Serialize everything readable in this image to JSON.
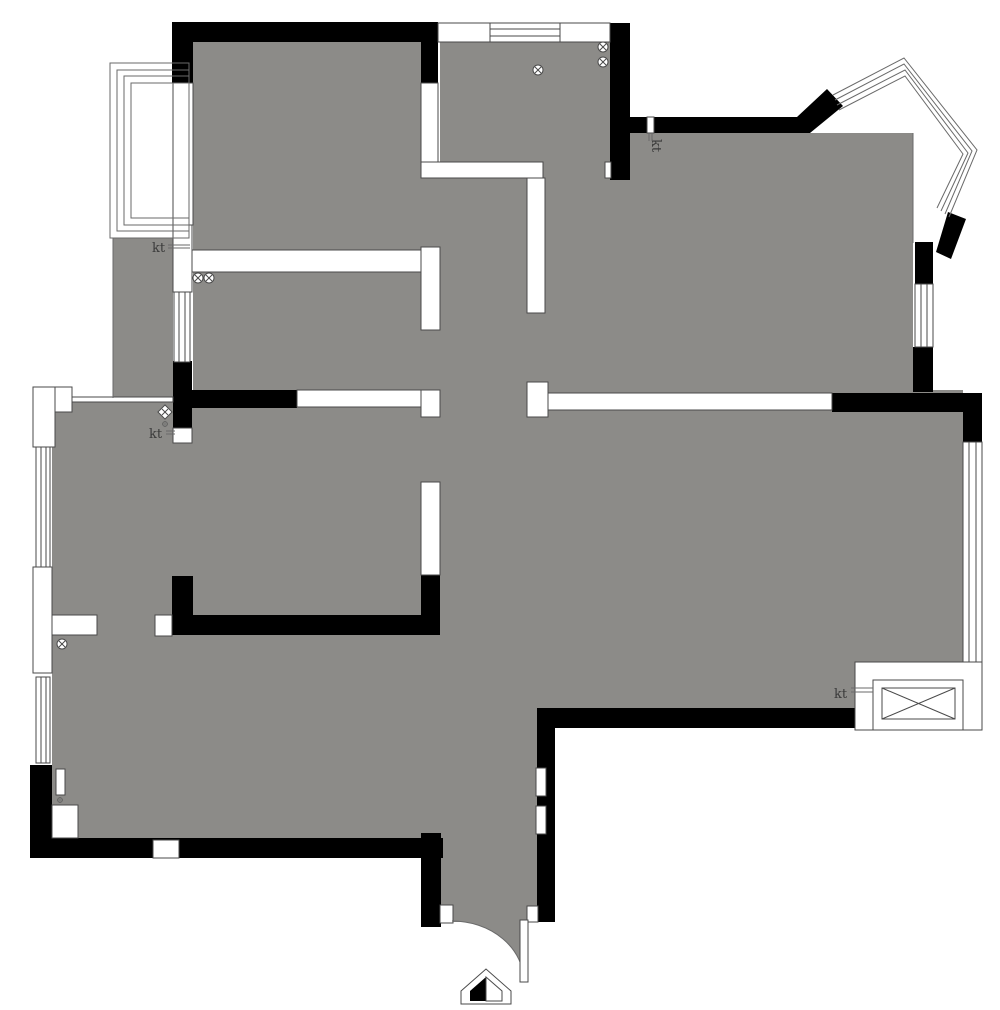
{
  "title": "apartment-floor-plan",
  "labels": {
    "kt1": "kt",
    "kt2": "kt",
    "kt3": "kt",
    "kt4": "kt"
  },
  "colors": {
    "background": "#ffffff",
    "floor": "#8c8b88",
    "wall": "#000000",
    "opening": "#ffffff",
    "line": "#4a4a4a",
    "label": "#3a3a3a"
  },
  "symbols": {
    "entrance_arrow": "entrance-arrow-icon",
    "door_swing": "door-swing-arc",
    "ceiling_lamp": "crossed-circle-lamp-icon",
    "ac_unit": "ac-outdoor-unit-box",
    "bay_window": "bay-window-lines",
    "radiator": "radiator-block"
  }
}
